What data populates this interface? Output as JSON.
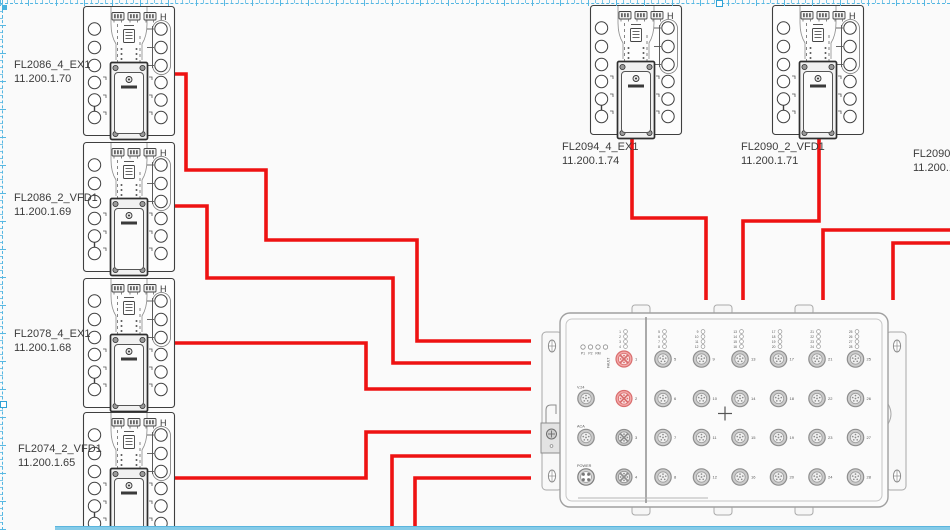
{
  "canvas": {
    "width": 950,
    "height": 530,
    "background": "#fafafa"
  },
  "colors": {
    "cable": "#ee1212",
    "device_stroke": "#3f3f3f",
    "switch_stroke": "#a0a0a0",
    "selection": "#53b6e2",
    "label_text": "#3c3c3c",
    "red_port_stroke": "#d96e6e",
    "red_port_fill": "#f3a8a8",
    "gray_port_stroke": "#8e8e8e",
    "gray_port_fill": "#cccccc"
  },
  "devices": [
    {
      "name": "FL2086_4_EX1",
      "ip": "11.200.1.70",
      "x": 83,
      "y": 6,
      "label_x": 14,
      "label_y": 59
    },
    {
      "name": "FL2086_2_VFD1",
      "ip": "11.200.1.69",
      "x": 83,
      "y": 142,
      "label_x": 14,
      "label_y": 192
    },
    {
      "name": "FL2078_4_EX1",
      "ip": "11.200.1.68",
      "x": 83,
      "y": 278,
      "label_x": 14,
      "label_y": 328
    },
    {
      "name": "FL2074_2_VFD1",
      "ip": "11.200.1.65",
      "x": 83,
      "y": 412,
      "label_x": 18,
      "label_y": 443
    },
    {
      "name": "FL2094_4_EX1",
      "ip": "11.200.1.74",
      "x": 590,
      "y": 5,
      "label_x": 562,
      "label_y": 141
    },
    {
      "name": "FL2090_2_VFD1",
      "ip": "11.200.1.71",
      "x": 772,
      "y": 5,
      "label_x": 741,
      "label_y": 141
    }
  ],
  "partial_device": {
    "name": "FL2090_4",
    "ip": "11.200.1.",
    "label_x": 913,
    "label_y": 148
  },
  "cables": {
    "color": "#ee1212",
    "width": 3.6,
    "routes": [
      {
        "from": "FL2086_4_EX1",
        "points": [
          [
            174,
            74
          ],
          [
            186,
            74
          ],
          [
            186,
            170
          ],
          [
            266,
            170
          ],
          [
            266,
            240
          ],
          [
            417,
            240
          ],
          [
            417,
            341
          ],
          [
            531,
            341
          ]
        ]
      },
      {
        "from": "FL2086_2_VFD1",
        "points": [
          [
            174,
            206
          ],
          [
            207,
            206
          ],
          [
            207,
            278
          ],
          [
            393,
            278
          ],
          [
            393,
            363
          ],
          [
            531,
            363
          ]
        ]
      },
      {
        "from": "FL2078_4_EX1",
        "points": [
          [
            174,
            343
          ],
          [
            366,
            343
          ],
          [
            366,
            389
          ],
          [
            531,
            389
          ]
        ]
      },
      {
        "from": "FL2074_2_VFD1",
        "points": [
          [
            174,
            478
          ],
          [
            366,
            478
          ],
          [
            366,
            432
          ],
          [
            531,
            432
          ]
        ]
      },
      {
        "from": "offscreen-bottom-1",
        "points": [
          [
            392,
            527
          ],
          [
            392,
            456
          ],
          [
            531,
            456
          ]
        ]
      },
      {
        "from": "offscreen-bottom-2",
        "points": [
          [
            415,
            527
          ],
          [
            415,
            478
          ],
          [
            531,
            478
          ]
        ]
      },
      {
        "from": "FL2094_4_EX1",
        "points": [
          [
            632,
            139
          ],
          [
            632,
            218
          ],
          [
            706,
            218
          ],
          [
            706,
            300
          ]
        ]
      },
      {
        "from": "FL2090_2_VFD1",
        "points": [
          [
            819,
            139
          ],
          [
            819,
            221
          ],
          [
            743,
            221
          ],
          [
            743,
            300
          ]
        ]
      },
      {
        "from": "offscreen-right-1",
        "points": [
          [
            950,
            230
          ],
          [
            823,
            230
          ],
          [
            823,
            300
          ]
        ]
      },
      {
        "from": "offscreen-right-2",
        "points": [
          [
            950,
            243
          ],
          [
            893,
            243
          ],
          [
            893,
            300
          ]
        ]
      }
    ]
  },
  "switch": {
    "status_leds": [
      "P1",
      "P2",
      "RM"
    ],
    "fault_label": "FAULT",
    "aux_ports": [
      {
        "label": "V.24",
        "type": "m12"
      },
      {
        "label": "ACA",
        "type": "m12"
      },
      {
        "label": "POWER",
        "type": "power"
      }
    ],
    "led_groups": [
      [
        1,
        2,
        3,
        4
      ],
      [
        5,
        6,
        7,
        8
      ],
      [
        9,
        10,
        11,
        12
      ],
      [
        13,
        14,
        15,
        16
      ],
      [
        17,
        18,
        19,
        20
      ],
      [
        21,
        22,
        23,
        24
      ],
      [
        25,
        26,
        27,
        28
      ]
    ],
    "port_columns": [
      [
        1,
        2,
        3,
        4
      ],
      [
        5,
        6,
        7,
        8
      ],
      [
        9,
        10,
        11,
        12
      ],
      [
        13,
        14,
        15,
        16
      ],
      [
        17,
        18,
        19,
        20
      ],
      [
        21,
        22,
        23,
        24
      ],
      [
        25,
        26,
        27,
        28
      ]
    ],
    "highlighted_ports": [
      1,
      2
    ]
  },
  "device_glyphs": {
    "rail_marker": "H"
  }
}
